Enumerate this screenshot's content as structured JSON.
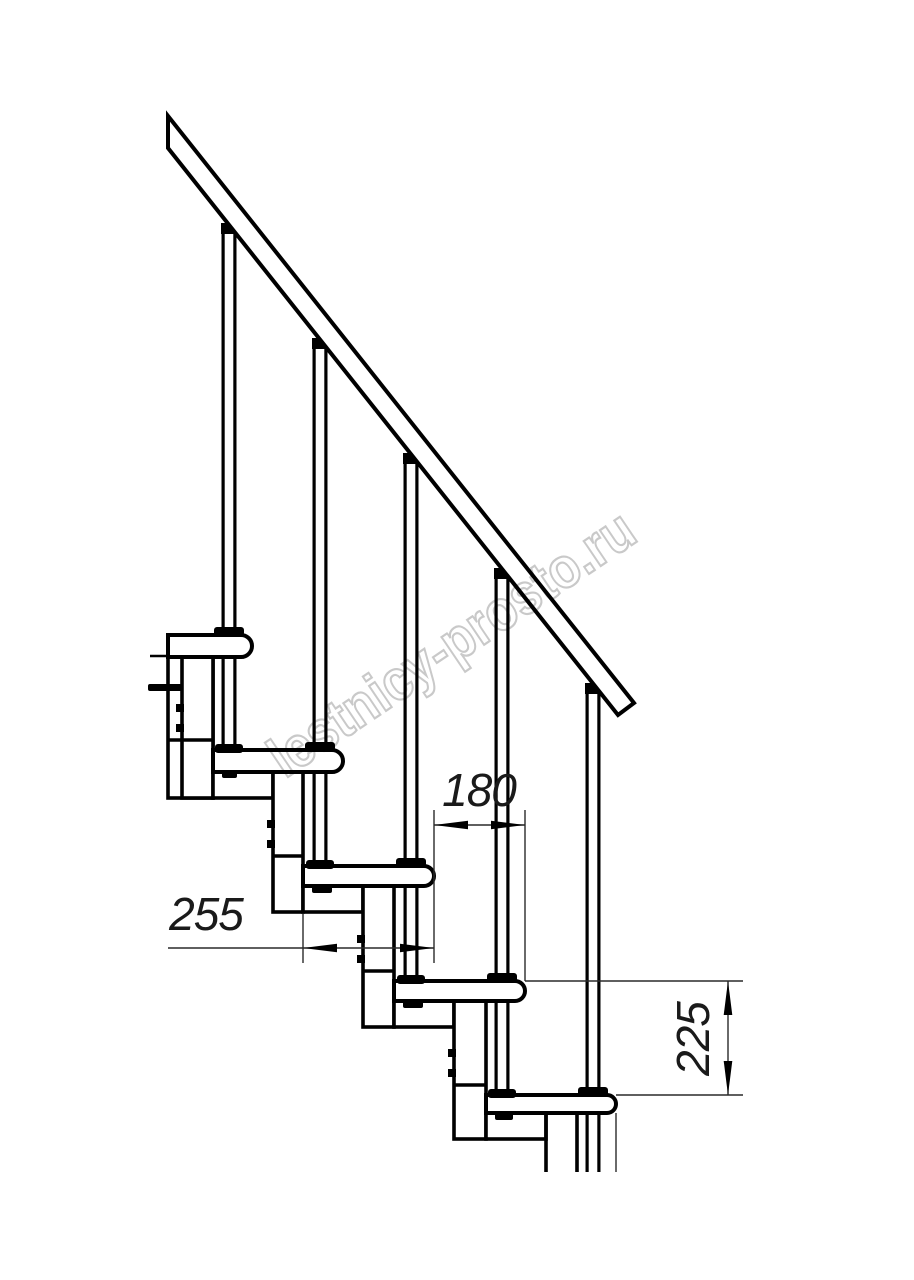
{
  "page": {
    "background": "#ffffff"
  },
  "drawing": {
    "type": "modular-staircase-side-elevation",
    "line_color": "#000000",
    "fill_color": "#ffffff",
    "treads_count": 5,
    "balusters_count": 5,
    "dimensions": {
      "tread_depth": "255",
      "step_run": "180",
      "step_rise": "225"
    },
    "watermark": {
      "text": "lestnicy-prosto.ru",
      "color": "#c9c9c9"
    }
  }
}
